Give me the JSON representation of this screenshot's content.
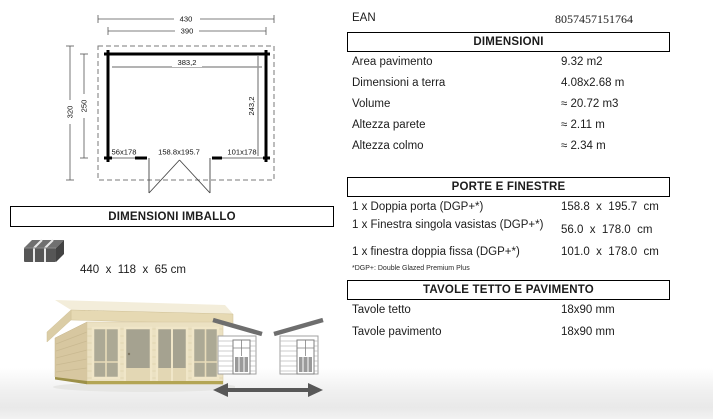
{
  "colors": {
    "page_bg": "#ffffff",
    "text": "#1c1c1c",
    "box_border": "#000000",
    "plan_gray_line": "#9a9a9a",
    "diagram_gray": "#6e6e6e",
    "shed_wood_front": "#ebe1c2",
    "shed_wood_side": "#d8c8a0",
    "shed_glass": "#aca995"
  },
  "ean": {
    "label": "EAN",
    "value": "8057457151764"
  },
  "plan": {
    "dim_roof_width": "430",
    "dim_wall_width": "390",
    "dim_inner_width": "383,2",
    "dim_roof_depth": "320",
    "dim_wall_depth": "250",
    "dim_inner_depth": "243,2",
    "opening_left": "56x178",
    "opening_center": "158.8x195.7",
    "opening_right": "101x178"
  },
  "imballo": {
    "title": "DIMENSIONI IMBALLO",
    "size": "440  x  118  x  65 cm",
    "weight": "860 kg",
    "icon": "package-bundle-icon"
  },
  "dimensioni": {
    "title": "DIMENSIONI",
    "rows": [
      {
        "label": "Area pavimento",
        "value": "9.32 m2"
      },
      {
        "label": "Dimensioni a terra",
        "value": "4.08x2.68 m"
      },
      {
        "label": "Volume",
        "value": "≈ 20.72 m3"
      },
      {
        "label": "Altezza parete",
        "value": "≈ 2.11 m"
      },
      {
        "label": "Altezza colmo",
        "value": "≈ 2.34 m"
      }
    ]
  },
  "porte_finestre": {
    "title": "PORTE E FINESTRE",
    "rows": [
      {
        "label": "1 x Doppia porta (DGP+*)",
        "value": "158.8  x  195.7  cm"
      },
      {
        "label": "1 x Finestra singola vasistas (DGP+*)",
        "value": "56.0  x  178.0  cm"
      },
      {
        "label": "1 x finestra doppia fissa (DGP+*)",
        "value": "101.0  x  178.0  cm"
      }
    ],
    "footnote": "*DGP+: Double Glazed Premium Plus"
  },
  "tavole": {
    "title": "TAVOLE TETTO E PAVIMENTO",
    "rows": [
      {
        "label": "Tavole tetto",
        "value": "18x90 mm"
      },
      {
        "label": "Tavole pavimento",
        "value": "18x90 mm"
      }
    ]
  },
  "footer_icons": {
    "roof_diagram": "reversible-roof-direction-icon",
    "product_photo": "wooden-cabin-photo"
  }
}
